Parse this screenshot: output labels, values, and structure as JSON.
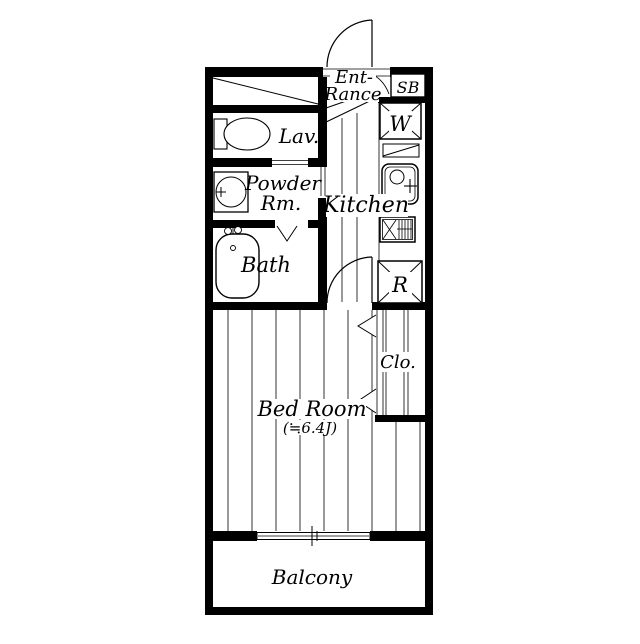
{
  "floorplan": {
    "labels": {
      "entrance_line1": "Ent-",
      "entrance_line2": "Rance",
      "shoe_box": "SB",
      "washing_machine": "W",
      "lavatory": "Lav.",
      "powder_room_line1": "Powder",
      "powder_room_line2": "Rm.",
      "kitchen": "Kitchen",
      "bath": "Bath",
      "refrigerator": "R",
      "closet": "Clo.",
      "bedroom": "Bed Room",
      "bedroom_size": "(≒6.4J)",
      "balcony": "Balcony"
    },
    "colors": {
      "wall": "#000000",
      "background": "#ffffff"
    }
  }
}
